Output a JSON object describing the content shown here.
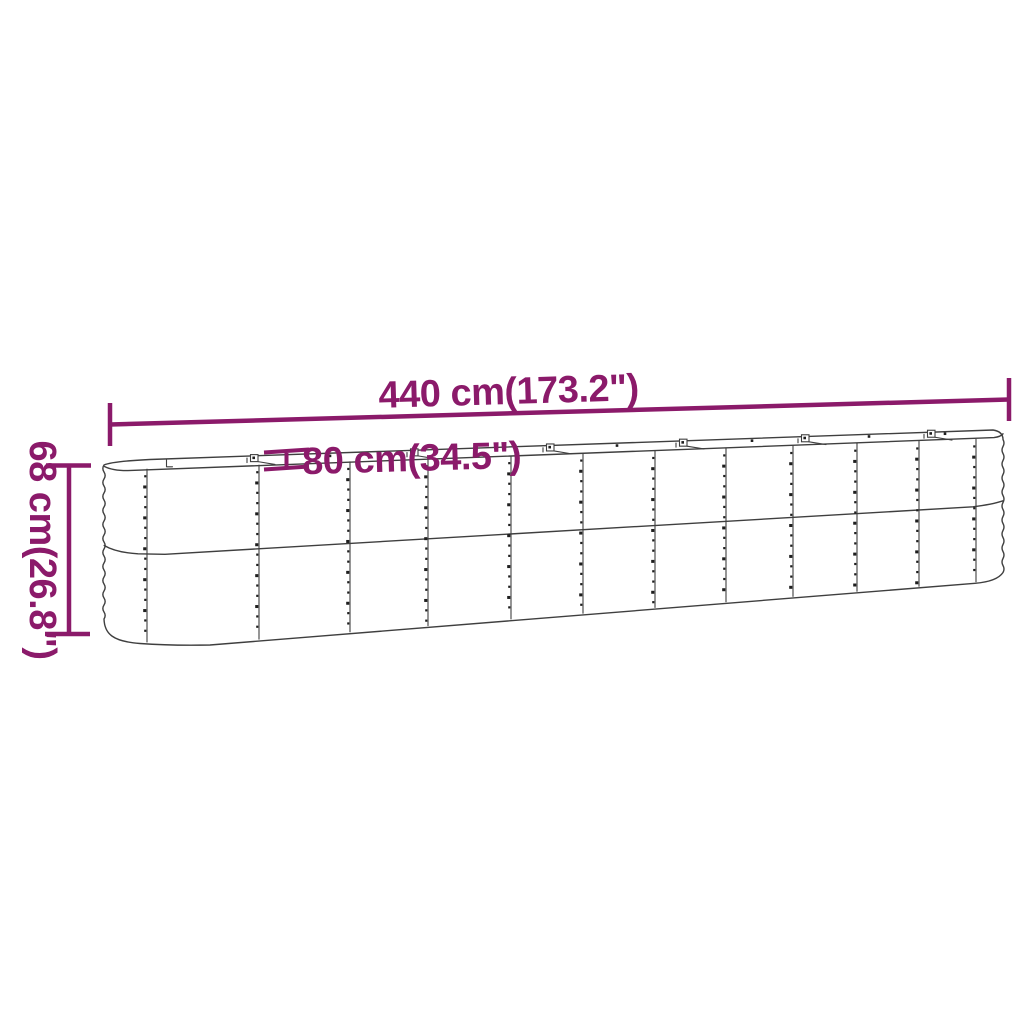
{
  "diagram": {
    "dimension_labels": {
      "length": "440 cm(173.2\")",
      "depth": "80 cm(34.5\")",
      "height": "68 cm(26.8\")"
    },
    "colors": {
      "dimension_annotation": "#8b1a6a",
      "drawing_outline": "#3f3f3f",
      "background": "#ffffff"
    }
  }
}
